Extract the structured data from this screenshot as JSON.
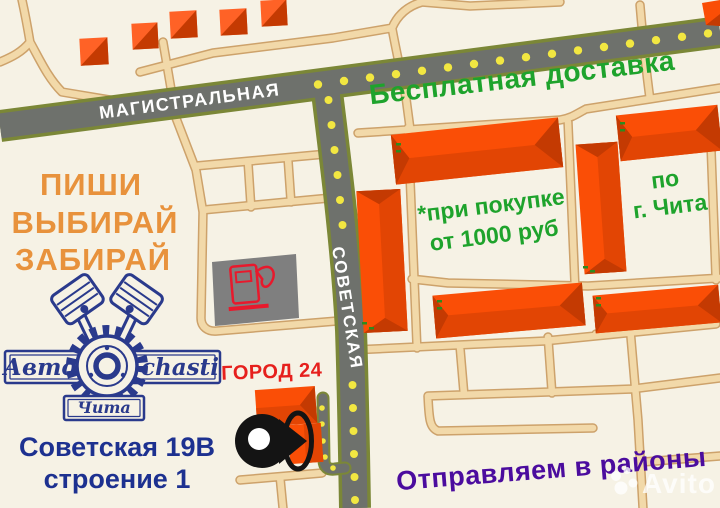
{
  "streets": {
    "magistralnaya": "МАГИСТРАЛЬНАЯ",
    "sovetskaya": "СОВЕТСКАЯ"
  },
  "promo": {
    "line1": "ПИШИ",
    "line2": "ВЫБИРАЙ",
    "line3": "ЗАБИРАЙ"
  },
  "delivery": {
    "headline": "Бесплатная доставка",
    "condition_line1": "*при покупке",
    "condition_line2": "от 1000 руб",
    "area_line1": "по",
    "area_line2": "г. Чита",
    "districts": "Отправляем в районы"
  },
  "store": {
    "name": "ГОРОД 24",
    "address_line1": "Советская 19В",
    "address_line2": "строение 1"
  },
  "logo": {
    "word_left": "Авто",
    "word_right": "chasti",
    "city": "Чита"
  },
  "watermark": {
    "brand": "Avito"
  },
  "colors": {
    "background": "#f6f2e5",
    "avenue": "#6e716c",
    "avenue_border": "#7b8737",
    "road_fill": "#f2d9a9",
    "road_border": "#cda26b",
    "dash_yellow": "#f2e741",
    "building": "#fa4e06",
    "building_mid": "#e24504",
    "building_dark": "#c43a02",
    "building_light": "#ff6226",
    "green": "#1ea32c",
    "green_dash": "#2e8a1e",
    "orange_text": "#e8923c",
    "red_text": "#e6201d",
    "blue_text": "#1d3190",
    "purple_text": "#4b0c9e",
    "navy": "#2a3a8c",
    "street_text": "#ffffff",
    "gas_gray": "#7f7f7f",
    "pump_red": "#e8192c",
    "pin_black": "#141414",
    "watermark_color": "rgba(255,255,255,0.78)"
  }
}
